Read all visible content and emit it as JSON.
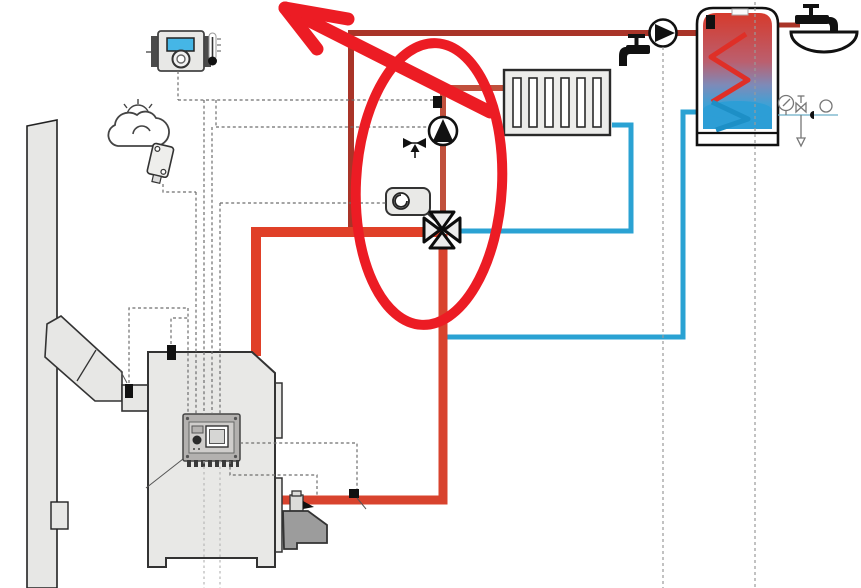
{
  "diagram": {
    "type": "hydronic-heating-system-schematic",
    "title": "",
    "visible_text": [],
    "components": {
      "chimney": "masonry-chimney-with-cleanout-door",
      "flue_duct": "angled-flue-connector-with-flue-gas-sensor",
      "boiler": "solid-fuel-boiler-with-control-panel",
      "burner": "pellet-burner-with-feed-fitting",
      "room_controller": "room-thermostat-with-blue-display-knob-and-thermometer",
      "outdoor_sensor": "weather-cloud-sun-and-outdoor-temperature-sensor",
      "radiator": "panel-radiator-6-sections",
      "circulation_pump": "heating-circuit-pump-triangle-up",
      "air_vent": "automatic-air-vent-symbol",
      "mixing_valve": "4-way-mixing-valve-cross",
      "valve_actuator": "rotary-actuator-motor",
      "supply_sensor": "flow-temperature-sensor-on-radiator-supply",
      "return_sensor": "return-temperature-sensor-on-bottom-pipe",
      "dhw_tank": "domestic-hot-water-cylinder-with-coil",
      "dhw_pump": "tank-loading-pump-triangle-right",
      "taps": [
        "cold-water-tap-left-of-pump",
        "hot-water-tap-with-basin-right-of-tank"
      ],
      "safety_group": "pressure-gauge-safety-valve-check-valve-expansion-fittings"
    },
    "annotation": {
      "shape": "red-ellipse-circling-pump-and-mixing-valve-plus-arrow-pointing-up-left",
      "color": "#ec1c24"
    },
    "colors": {
      "pipeSupply": "#e04028",
      "pipeReturn": "#d8432e",
      "pipeRadiator": "#c0503c",
      "pipeDhw": "#a93428",
      "pipeBlue": "#2aa2d3",
      "annotation": "#ec1c24",
      "boilerFill": "#e8e8e6",
      "burnerFill": "#9c9c9c",
      "tankHot": "#d63a2c",
      "tankCold": "#2f9fd8",
      "displayBlue": "#45b6e6",
      "wire": "#6e6e6e"
    }
  }
}
